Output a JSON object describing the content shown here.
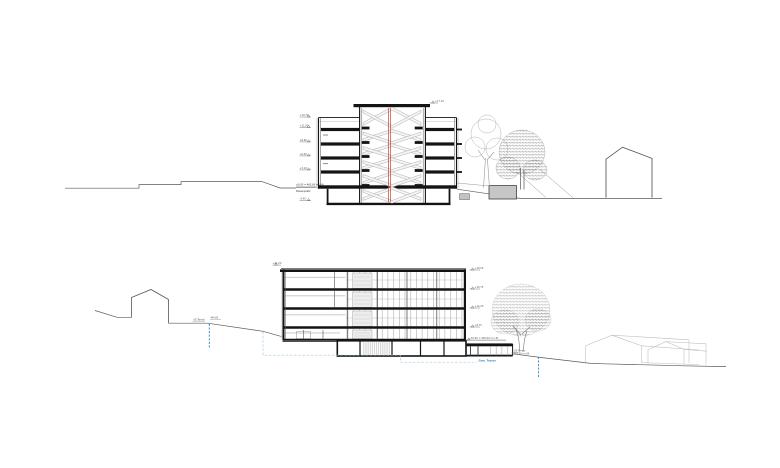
{
  "top_section": {
    "levels_left": [
      "+14.70",
      "+11.80",
      "+8.90",
      "+6.00",
      "+3.10"
    ],
    "below_level": "-3.40",
    "datum_label": "±0.00 = 465.60 m ü.M.",
    "ground_label": "Pausenplatz",
    "tower_level": "+17.10"
  },
  "bottom_section": {
    "roof_level": "+21.00",
    "levels_right": [
      "+19.25",
      "+15.75",
      "+12.25",
      "+8.75"
    ],
    "datum_label": "±0.00 = 465.00 m ü.M.",
    "terrain_left_label": "OK Terrain",
    "terrain_left_value": "464.60",
    "annex_terrain_label": "OK Terrain",
    "annex_terrain_value": "461.90 m ü.M.",
    "utility_label": "Gew. Trasse"
  },
  "colors": {
    "section_cut_red": "#c0452b",
    "water_blue": "#2e86c1",
    "utility_light_blue": "#a9cce3",
    "linework": "#141414"
  }
}
